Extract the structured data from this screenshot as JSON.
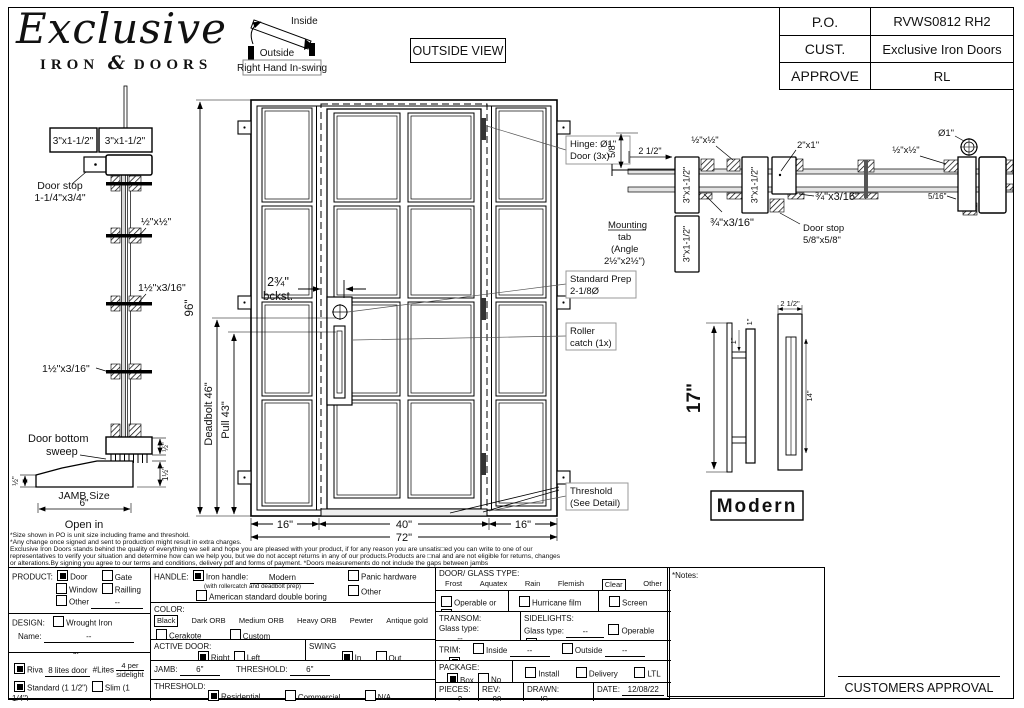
{
  "header": {
    "logo_script": "Exclusive",
    "logo_iron": "IRON",
    "logo_amp": "&",
    "logo_doors": "DOORS",
    "view_label": "OUTSIDE VIEW",
    "table": [
      {
        "label": "P.O.",
        "value": "RVWS0812 RH2"
      },
      {
        "label": "CUST.",
        "value": "Exclusive Iron Doors"
      },
      {
        "label": "APPROVE",
        "value": "RL"
      }
    ]
  },
  "swing": {
    "inside": "Inside",
    "outside": "Outside",
    "caption": "Right Hand In-swing"
  },
  "drawing": {
    "left_section": {
      "tube1": "3\"x1-1/2\"",
      "tube2": "3\"x1-1/2\"",
      "door_stop_1": "Door stop",
      "door_stop_2": "1-1/4\"x3/4\"",
      "half_half": "½\"x½\"",
      "mid_316": "1½\"x3/16\"",
      "low_316": "1½\"x3/16\"",
      "sweep_1": "Door bottom",
      "sweep_2": "sweep",
      "dim_half_left": "½\"",
      "dim_half_right": "½\"",
      "dim_one_half": "1½\"",
      "jamb_size": "JAMB Size",
      "jamb_val": "6\"",
      "open_in": "Open in"
    },
    "elevation": {
      "dim_96": "96\"",
      "dim_deadbolt": "Deadbolt 46\"",
      "dim_pull": "Pull 43\"",
      "bckst_1": "2¾\"",
      "bckst_2": "bckst.",
      "dim_16l": "16\"",
      "dim_40": "40\"",
      "dim_16r": "16\"",
      "dim_72": "72\"",
      "hinge_1": "Hinge: Ø1\"",
      "hinge_2": "Door (3x)",
      "prep_1": "Standard Prep",
      "prep_2": "2-1/8Ø",
      "roller_1": "Roller",
      "roller_2": "catch (1x)",
      "thresh_1": "Threshold",
      "thresh_2": "(See Detail)"
    },
    "head_section": {
      "dim_58": "5/8\"",
      "dim_212": "2 1/2\"",
      "tube_a": "3\"x1-1/2\"",
      "tube_b": "3\"x1-1/2\"",
      "tube_c": "3\"x1-1/2\"",
      "half_half_l": "½\"x½\"",
      "half_half_r": "½\"x½\"",
      "two_one": "2\"x1\"",
      "q316_l": "¾\"x3/16\"",
      "q316_r": "¾\"x3/16\"",
      "stop_1": "Door stop",
      "stop_2": "5/8\"x5/8\"",
      "mount_1": "Mounting",
      "mount_2": "tab",
      "mount_3": "(Angle",
      "mount_4": "2½\"x2½\")",
      "dia_1": "Ø1\"",
      "dim_516": "5/16\""
    },
    "handle": {
      "dim_17": "17\"",
      "dim_1a": "1\"",
      "dim_1b": "1\"",
      "dim_212": "2 1/2\"",
      "dim_14": "14\"",
      "style": "Modern"
    }
  },
  "disclaimer": {
    "l1": "*Size shown in PO is unit size including frame and threshold.",
    "l2": "*Any change once signed and sent to production might result in extra charges.",
    "l3": "Exclusive Iron Doors stands behind the quality of everything we sell and hope you are pleased with your product, if for any reason you are unsatis□ed you can write to one of our",
    "l4": "representatives to verify your situation and determine how can we help you, but we do not accept returns in any of our products.Products are □nal and are not eligible for returns, changes",
    "l5": "or alterations.By signing you agree to our terms and conditions, delivery pdf and forms of payment. *Doors measurements do not include the gaps between jambs"
  },
  "form": {
    "product": {
      "label": "PRODUCT:",
      "door": "Door",
      "gate": "Gate",
      "window": "Window",
      "railing": "Railling",
      "other": "Other",
      "dash": "--"
    },
    "design": {
      "label": "DESIGN:",
      "wrought": "Wrought Iron",
      "name_label": "Name:",
      "dash": "--",
      "or": "or"
    },
    "riva": {
      "riva": "Riva",
      "lites": "8 lites door",
      "hash": "#Lites",
      "per1": "4 per",
      "per2": "sidelight",
      "standard": "Standard (1 1/2\")",
      "slim": "Slim (1 1/4\")"
    },
    "handle": {
      "label": "HANDLE:",
      "iron": "Iron handle:",
      "value": "Modern",
      "note": "(with rollercatch and deadbolt prep)",
      "american": "American standard double boring",
      "panic": "Panic hardware",
      "other": "Other"
    },
    "color": {
      "label": "COLOR:",
      "black": "Black",
      "dark": "Dark ORB",
      "medium": "Medium ORB",
      "heavy": "Heavy ORB",
      "pewter": "Pewter",
      "antique": "Antique gold",
      "cerakote": "Cerakote",
      "custom": "Custom"
    },
    "active": {
      "label": "ACTIVE DOOR:",
      "right": "Right",
      "left": "Left"
    },
    "swing": {
      "label": "SWING",
      "in": "In",
      "out": "Out"
    },
    "jamb": {
      "label": "JAMB:",
      "value": "6\"",
      "threshold_label": "THRESHOLD:",
      "threshold_value": "6\""
    },
    "threshold": {
      "label": "THRESHOLD:",
      "residential": "Residential",
      "commercial": "Commercial",
      "na": "N/A"
    },
    "glass": {
      "label": "DOOR/ GLASS TYPE:",
      "frost": "Frost",
      "aquatex": "Aquatex",
      "rain": "Rain",
      "flemish": "Flemish",
      "clear": "Clear",
      "other": "Other"
    },
    "operable": {
      "operable": "Operable",
      "or": "or",
      "fixed": "Fixed",
      "hurricane": "Hurricane film",
      "screen": "Screen"
    },
    "transom": {
      "label": "TRANSOM:",
      "glass_type": "Glass type:",
      "dash": "--"
    },
    "sidelights": {
      "label": "SIDELIGHTS:",
      "glass_type": "Glass type:",
      "dash": "--",
      "operable": "Operable",
      "fixed": "Fixed"
    },
    "trim": {
      "label": "TRIM:",
      "inside": "Inside",
      "dash1": "--",
      "outside": "Outside",
      "dash2": "--",
      "na": "N/A"
    },
    "package": {
      "label": "PACKAGE:",
      "box": "Box",
      "nobox": "No box",
      "install": "Install",
      "delivery": "Delivery",
      "ltl": "LTL"
    },
    "meta": {
      "pieces_label": "PIECES:",
      "pieces": "2",
      "rev_label": "REV:",
      "rev": "00",
      "drawn_label": "DRAWN:",
      "drawn": "IS",
      "date_label": "DATE:",
      "date": "12/08/22"
    },
    "notes_label": "*Notes:",
    "approval": "CUSTOMERS APPROVAL"
  }
}
